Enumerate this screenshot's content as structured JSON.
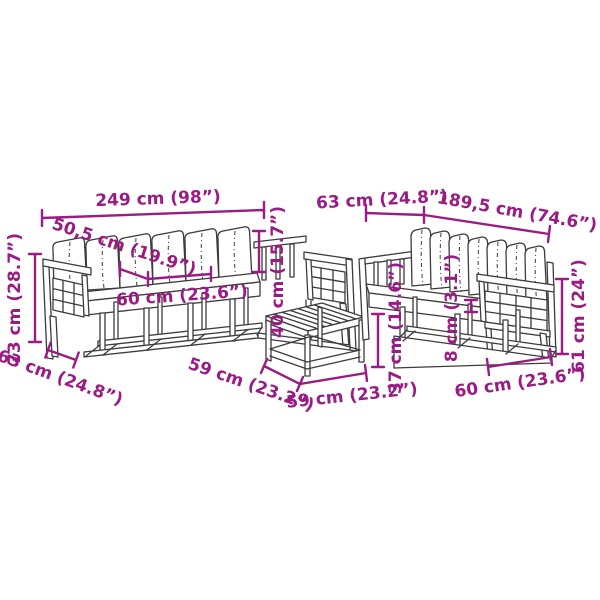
{
  "colors": {
    "background": "#ffffff",
    "dimension_accent": "#9b1b84",
    "line_art": "#3c3c3c"
  },
  "annotations": {
    "left_sofa": {
      "overall_width": "249 cm (98”)",
      "cushion_width": "50,5 cm (19.9”)",
      "seat_depth": "60 cm (23.6”)",
      "backrest_height": "40 cm (15.7”)",
      "overall_height": "73 cm (28.7”)",
      "side_depth": "63 cm (24.8”)",
      "section_width": "59 cm (23.2”)"
    },
    "coffee_table": {
      "top_width": "59 cm (23.2”)",
      "height": "37 cm (14.6”)"
    },
    "right_sofa": {
      "side_depth": "63 cm (24.8”)",
      "overall_width": "189,5 cm (74.6”)",
      "cushion_thickness": "8 cm (3.1”)",
      "overall_height": "61 cm (24”)",
      "seat_width": "60 cm (23.6”)"
    }
  }
}
